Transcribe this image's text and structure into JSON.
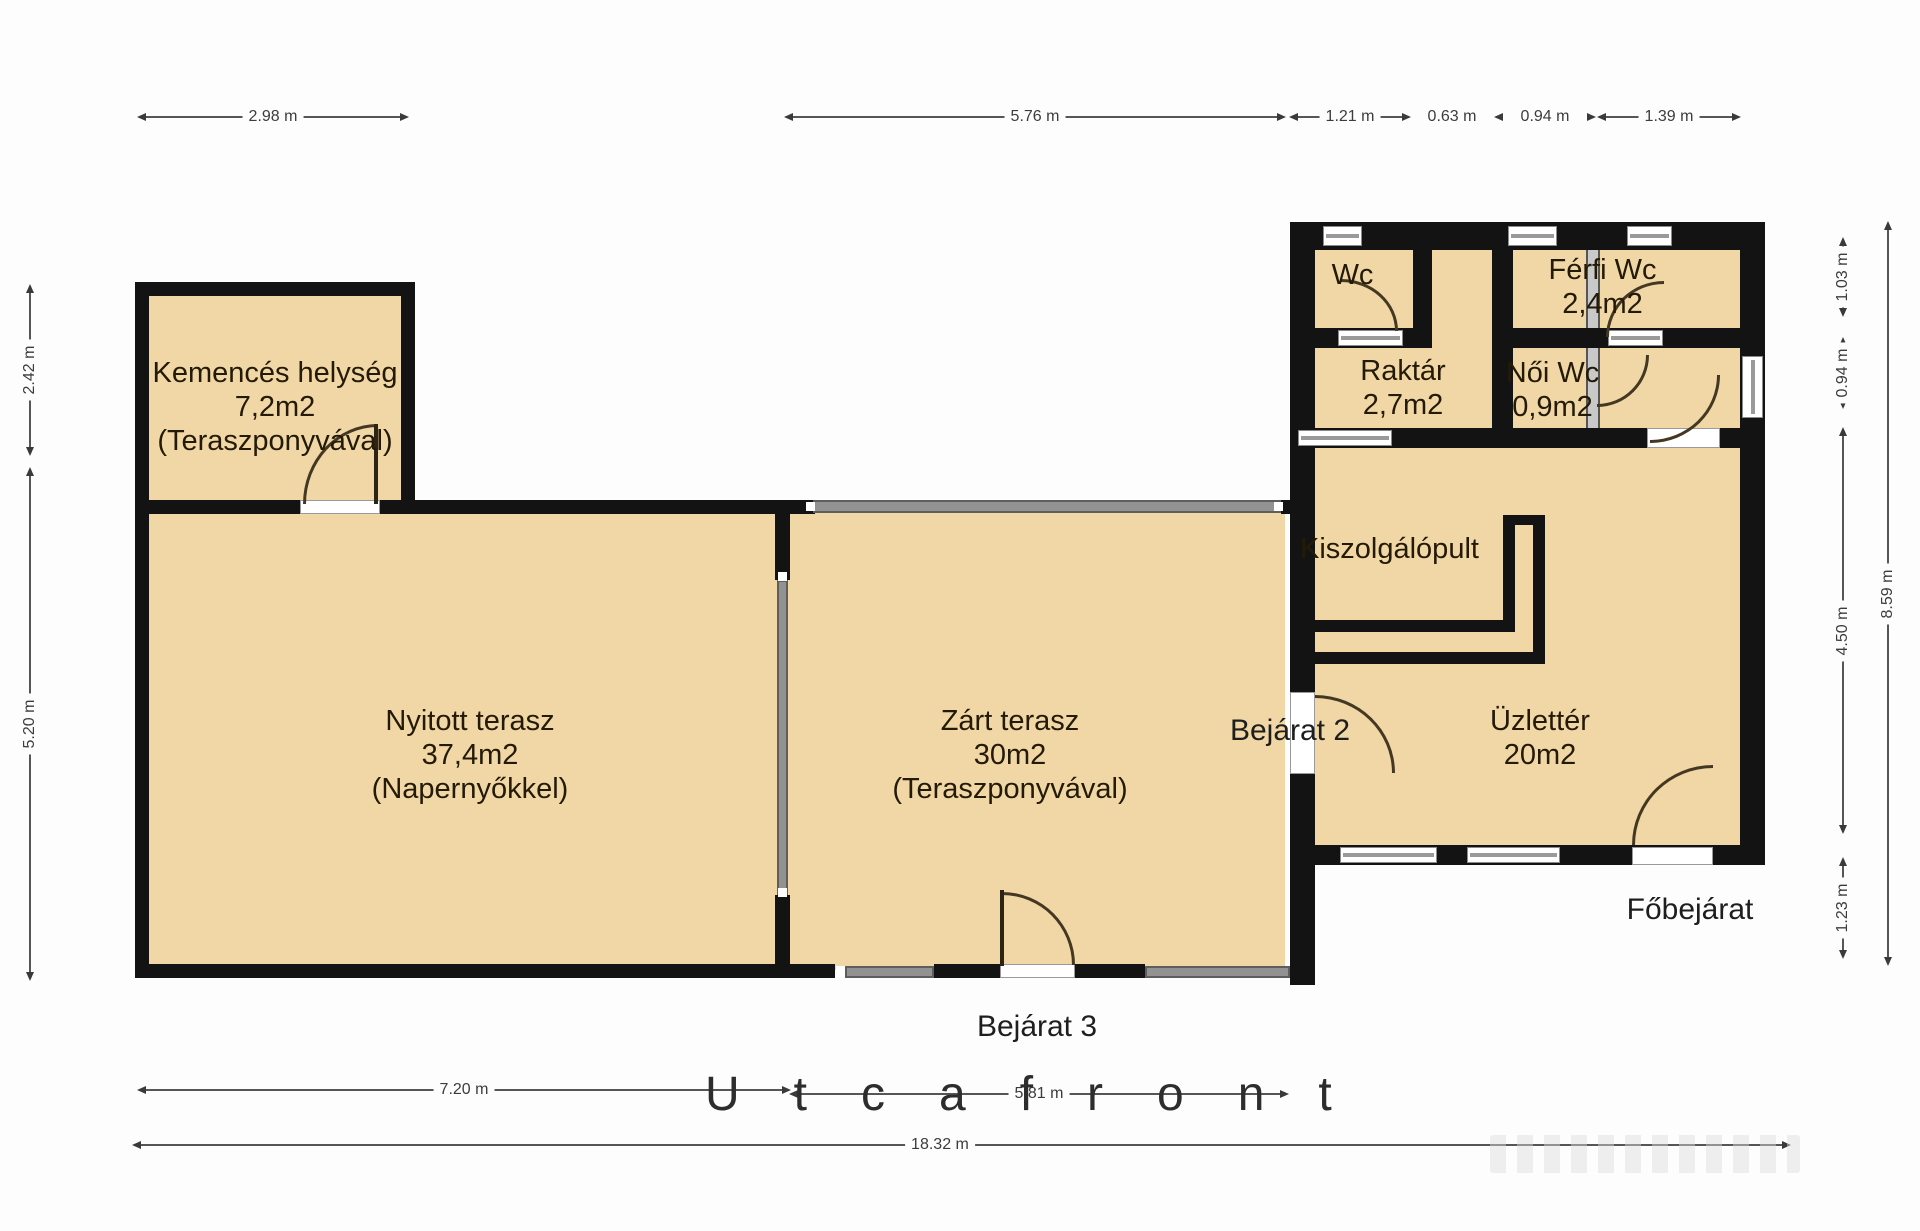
{
  "rooms": {
    "kemences": {
      "name": "Kemencés helység",
      "area": "7,2m2",
      "note": "(Teraszponyvával)"
    },
    "nyitott": {
      "name": "Nyitott terasz",
      "area": "37,4m2",
      "note": "(Napernyőkkel)"
    },
    "zart": {
      "name": "Zárt terasz",
      "area": "30m2",
      "note": "(Teraszponyvával)"
    },
    "wc": {
      "name": "Wc"
    },
    "ferfi_wc": {
      "name": "Férfi Wc",
      "area": "2,4m2"
    },
    "raktar": {
      "name": "Raktár",
      "area": "2,7m2"
    },
    "noi_wc": {
      "name": "Női Wc",
      "area": "0,9m2"
    },
    "kiszolgalopult": {
      "name": "Kiszolgálópult"
    },
    "uzletter": {
      "name": "Üzlettér",
      "area": "20m2"
    }
  },
  "entrances": {
    "bejarat2": "Bejárat 2",
    "bejarat3": "Bejárat 3",
    "fobejarat": "Főbejárat"
  },
  "street_label": "Utcafront",
  "dimensions": {
    "top": [
      "2.98 m",
      "5.76 m",
      "1.21 m",
      "0.63 m",
      "0.94 m",
      "1.39 m"
    ],
    "left": [
      "2.42 m",
      "5.20 m"
    ],
    "right": [
      "1.03 m",
      "0.94 m",
      "4.50 m",
      "1.23 m",
      "8.59 m"
    ],
    "bottom": [
      "7.20 m",
      "5.81 m",
      "18.32 m"
    ]
  },
  "colors": {
    "room_fill": "#f0d7a5",
    "wall": "#131313",
    "glazing": "#929292",
    "dimension_text": "#3c3c3c"
  }
}
